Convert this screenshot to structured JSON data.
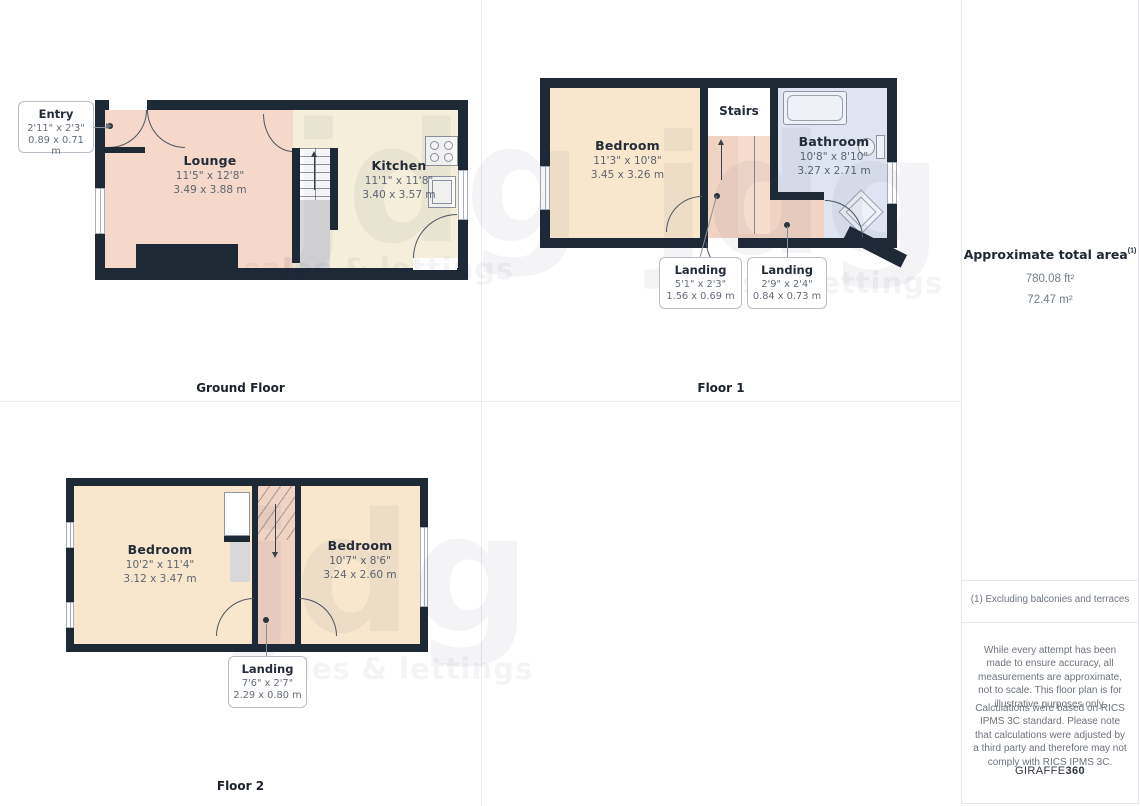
{
  "ground_floor": {
    "caption": "Ground Floor",
    "entry": {
      "title": "Entry",
      "imperial": "2'11\" x 2'3\"",
      "metric": "0.89 x 0.71 m"
    },
    "lounge": {
      "name": "Lounge",
      "imperial": "11'5\" x 12'8\"",
      "metric": "3.49 x 3.88 m"
    },
    "kitchen": {
      "name": "Kitchen",
      "imperial": "11'1\" x 11'8\"",
      "metric": "3.40 x 3.57 m"
    }
  },
  "floor1": {
    "caption": "Floor 1",
    "bedroom": {
      "name": "Bedroom",
      "imperial": "11'3\" x 10'8\"",
      "metric": "3.45 x 3.26 m"
    },
    "stairs_label": "Stairs",
    "bathroom": {
      "name": "Bathroom",
      "imperial": "10'8\" x 8'10\"",
      "metric": "3.27 x 2.71 m"
    },
    "landing_small": {
      "title": "Landing",
      "imperial": "5'1\" x 2'3\"",
      "metric": "1.56 x 0.69 m"
    },
    "landing_tiny": {
      "title": "Landing",
      "imperial": "2'9\" x 2'4\"",
      "metric": "0.84 x 0.73 m"
    }
  },
  "floor2": {
    "caption": "Floor 2",
    "bedroom_left": {
      "name": "Bedroom",
      "imperial": "10'2\" x 11'4\"",
      "metric": "3.12 x 3.47 m"
    },
    "bedroom_right": {
      "name": "Bedroom",
      "imperial": "10'7\" x 8'6\"",
      "metric": "3.24 x 2.60 m"
    },
    "landing": {
      "title": "Landing",
      "imperial": "7'6\" x 2'7\"",
      "metric": "2.29 x 0.80 m"
    }
  },
  "sidebar": {
    "area_title": "Approximate total area",
    "area_sup": "(1)",
    "area_ft": "780.08 ft²",
    "area_m": "72.47 m²",
    "footnote": "(1) Excluding balconies and terraces",
    "disclaimer_accuracy": "While every attempt has been made to ensure accuracy, all measurements are approximate, not to scale. This floor plan is for illustrative purposes only.",
    "disclaimer_rics": "Calculations were based on RICS IPMS 3C standard. Please note that calculations were adjusted by a third party and therefore may not comply with RICS IPMS 3C.",
    "brand": "GIRAFFE",
    "brand_bold": "360"
  },
  "watermark": {
    "logo": "jdg",
    "tagline": "sales & lettings"
  },
  "colors": {
    "wall": "#1e2936",
    "lounge_pink": "#f5d8c9",
    "kitchen_cream": "#f4eeda",
    "bedroom_cream": "#f9e7cd",
    "bathroom_blue": "#dfe4f2",
    "landing_pink": "#f1d3c4",
    "understairs_gray": "#d8d8da"
  }
}
